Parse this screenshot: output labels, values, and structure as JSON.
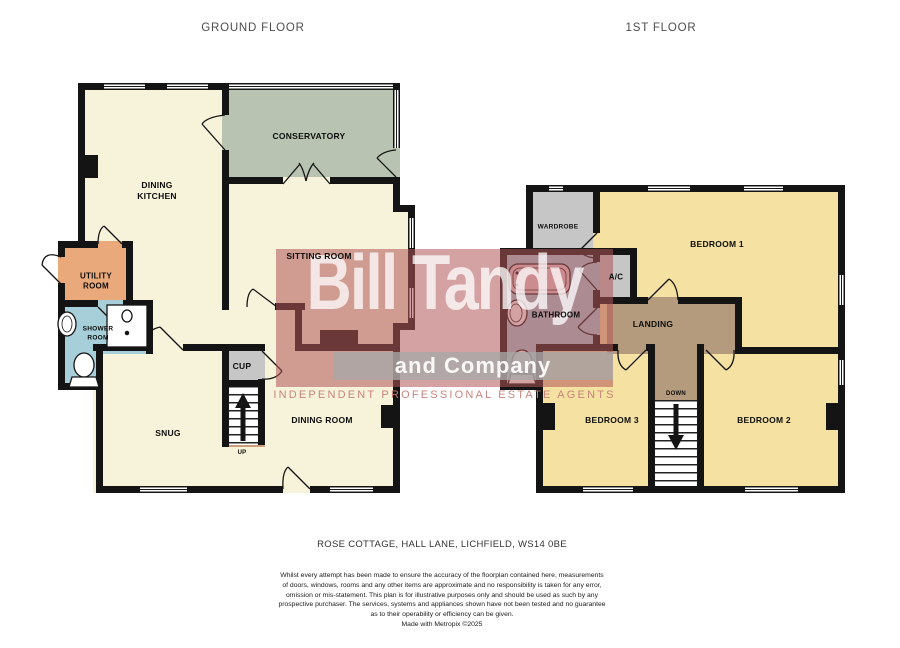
{
  "ground": {
    "title": "GROUND FLOOR",
    "dining_kitchen_line1": "DINING",
    "dining_kitchen_line2": "KITCHEN",
    "conservatory": "CONSERVATORY",
    "sitting_room": "SITTING ROOM",
    "utility_line1": "UTILITY",
    "utility_line2": "ROOM",
    "shower_line1": "SHOWER",
    "shower_line2": "ROOM",
    "snug": "SNUG",
    "cupboard": "CUP",
    "stairs_up": "UP",
    "dining_room": "DINING ROOM"
  },
  "first": {
    "title": "1ST FLOOR",
    "wardrobe": "WARDROBE",
    "bedroom1": "BEDROOM 1",
    "bathroom": "BATHROOM",
    "airing_cupboard": "A/C",
    "landing": "LANDING",
    "stairs_down": "DOWN",
    "bedroom3": "BEDROOM 3",
    "bedroom2": "BEDROOM 2"
  },
  "watermark": {
    "name_line1": "Bill Tandy",
    "name_line2": "and Company",
    "tagline": "INDEPENDENT PROFESSIONAL ESTATE AGENTS"
  },
  "address": "ROSE COTTAGE, HALL LANE, LICHFIELD, WS14 0BE",
  "disclaimer": [
    "Whilst every attempt has been made to ensure the accuracy of the floorplan contained here, measurements",
    "of doors, windows, rooms and any other items are approximate and no responsibility is taken for any error,",
    "omission or mis-statement. This plan is for illustrative purposes only and should be used as such by any",
    "prospective purchaser. The services, systems and appliances shown have not been tested and no guarantee",
    "as to their operability or efficiency can be given.",
    "Made with Metropix ©2025"
  ],
  "colors": {
    "room_cream": "#f7f2da",
    "conservatory_green": "#b9c3b2",
    "bedroom_yellow": "#f5e2a2",
    "landing_brown": "#b49b7d",
    "utility_orange": "#e9a97a",
    "wet_room_blue": "#a6cfd9",
    "storage_grey": "#c6c6c6",
    "bath_pink": "#eecdd2",
    "wall_black": "#141414",
    "watermark_red": "#b05558"
  }
}
